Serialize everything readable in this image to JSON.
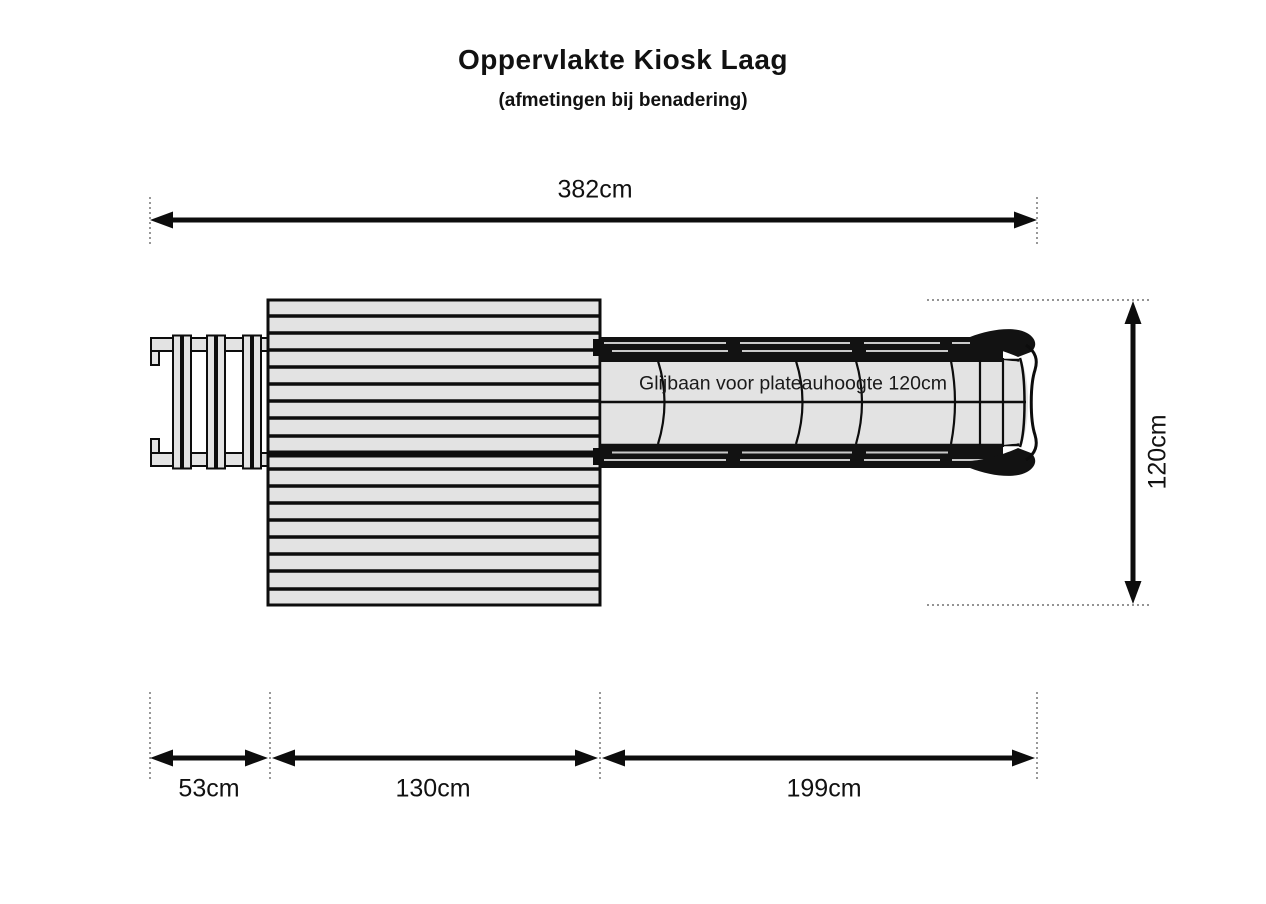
{
  "title": "Oppervlakte Kiosk Laag",
  "subtitle": "(afmetingen bij benadering)",
  "drawing": {
    "slide_label": "Glijbaan voor plateauhoogte 120cm"
  },
  "dimensions": {
    "total_width": "382cm",
    "depth": "120cm",
    "ladder_width": "53cm",
    "platform_width": "130cm",
    "slide_length": "199cm"
  },
  "colors": {
    "line": "#0d0d0d",
    "fill_gray": "#e3e3e3",
    "background": "#ffffff"
  }
}
